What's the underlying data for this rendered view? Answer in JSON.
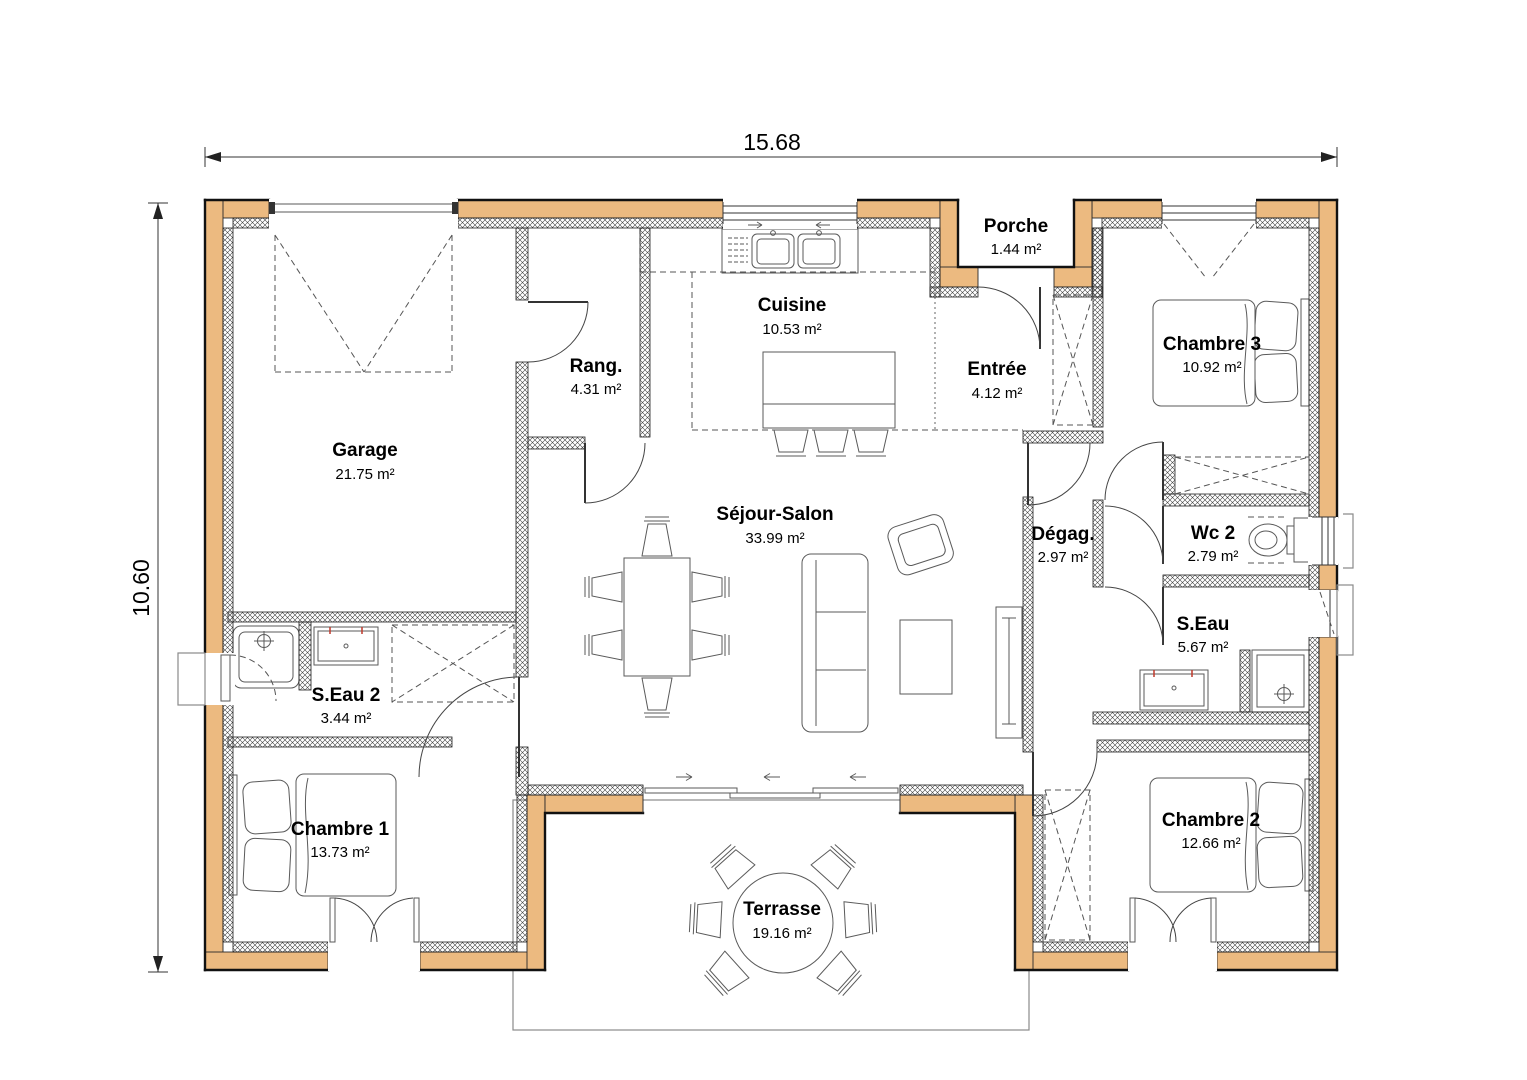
{
  "plan": {
    "width_dim": "15.68",
    "height_dim": "10.60",
    "colors": {
      "wall": "#ecba80",
      "line": "#111111"
    },
    "rooms": [
      {
        "name": "Porche",
        "area": "1.44 m²"
      },
      {
        "name": "Cuisine",
        "area": "10.53 m²"
      },
      {
        "name": "Rang.",
        "area": "4.31 m²"
      },
      {
        "name": "Entrée",
        "area": "4.12 m²"
      },
      {
        "name": "Chambre 3",
        "area": "10.92 m²"
      },
      {
        "name": "Garage",
        "area": "21.75 m²"
      },
      {
        "name": "Séjour-Salon",
        "area": "33.99 m²"
      },
      {
        "name": "Dégag.",
        "area": "2.97 m²"
      },
      {
        "name": "Wc 2",
        "area": "2.79 m²"
      },
      {
        "name": "S.Eau",
        "area": "5.67 m²"
      },
      {
        "name": "S.Eau 2",
        "area": "3.44 m²"
      },
      {
        "name": "Chambre 1",
        "area": "13.73 m²"
      },
      {
        "name": "Chambre 2",
        "area": "12.66 m²"
      },
      {
        "name": "Terrasse",
        "area": "19.16 m²"
      }
    ]
  }
}
